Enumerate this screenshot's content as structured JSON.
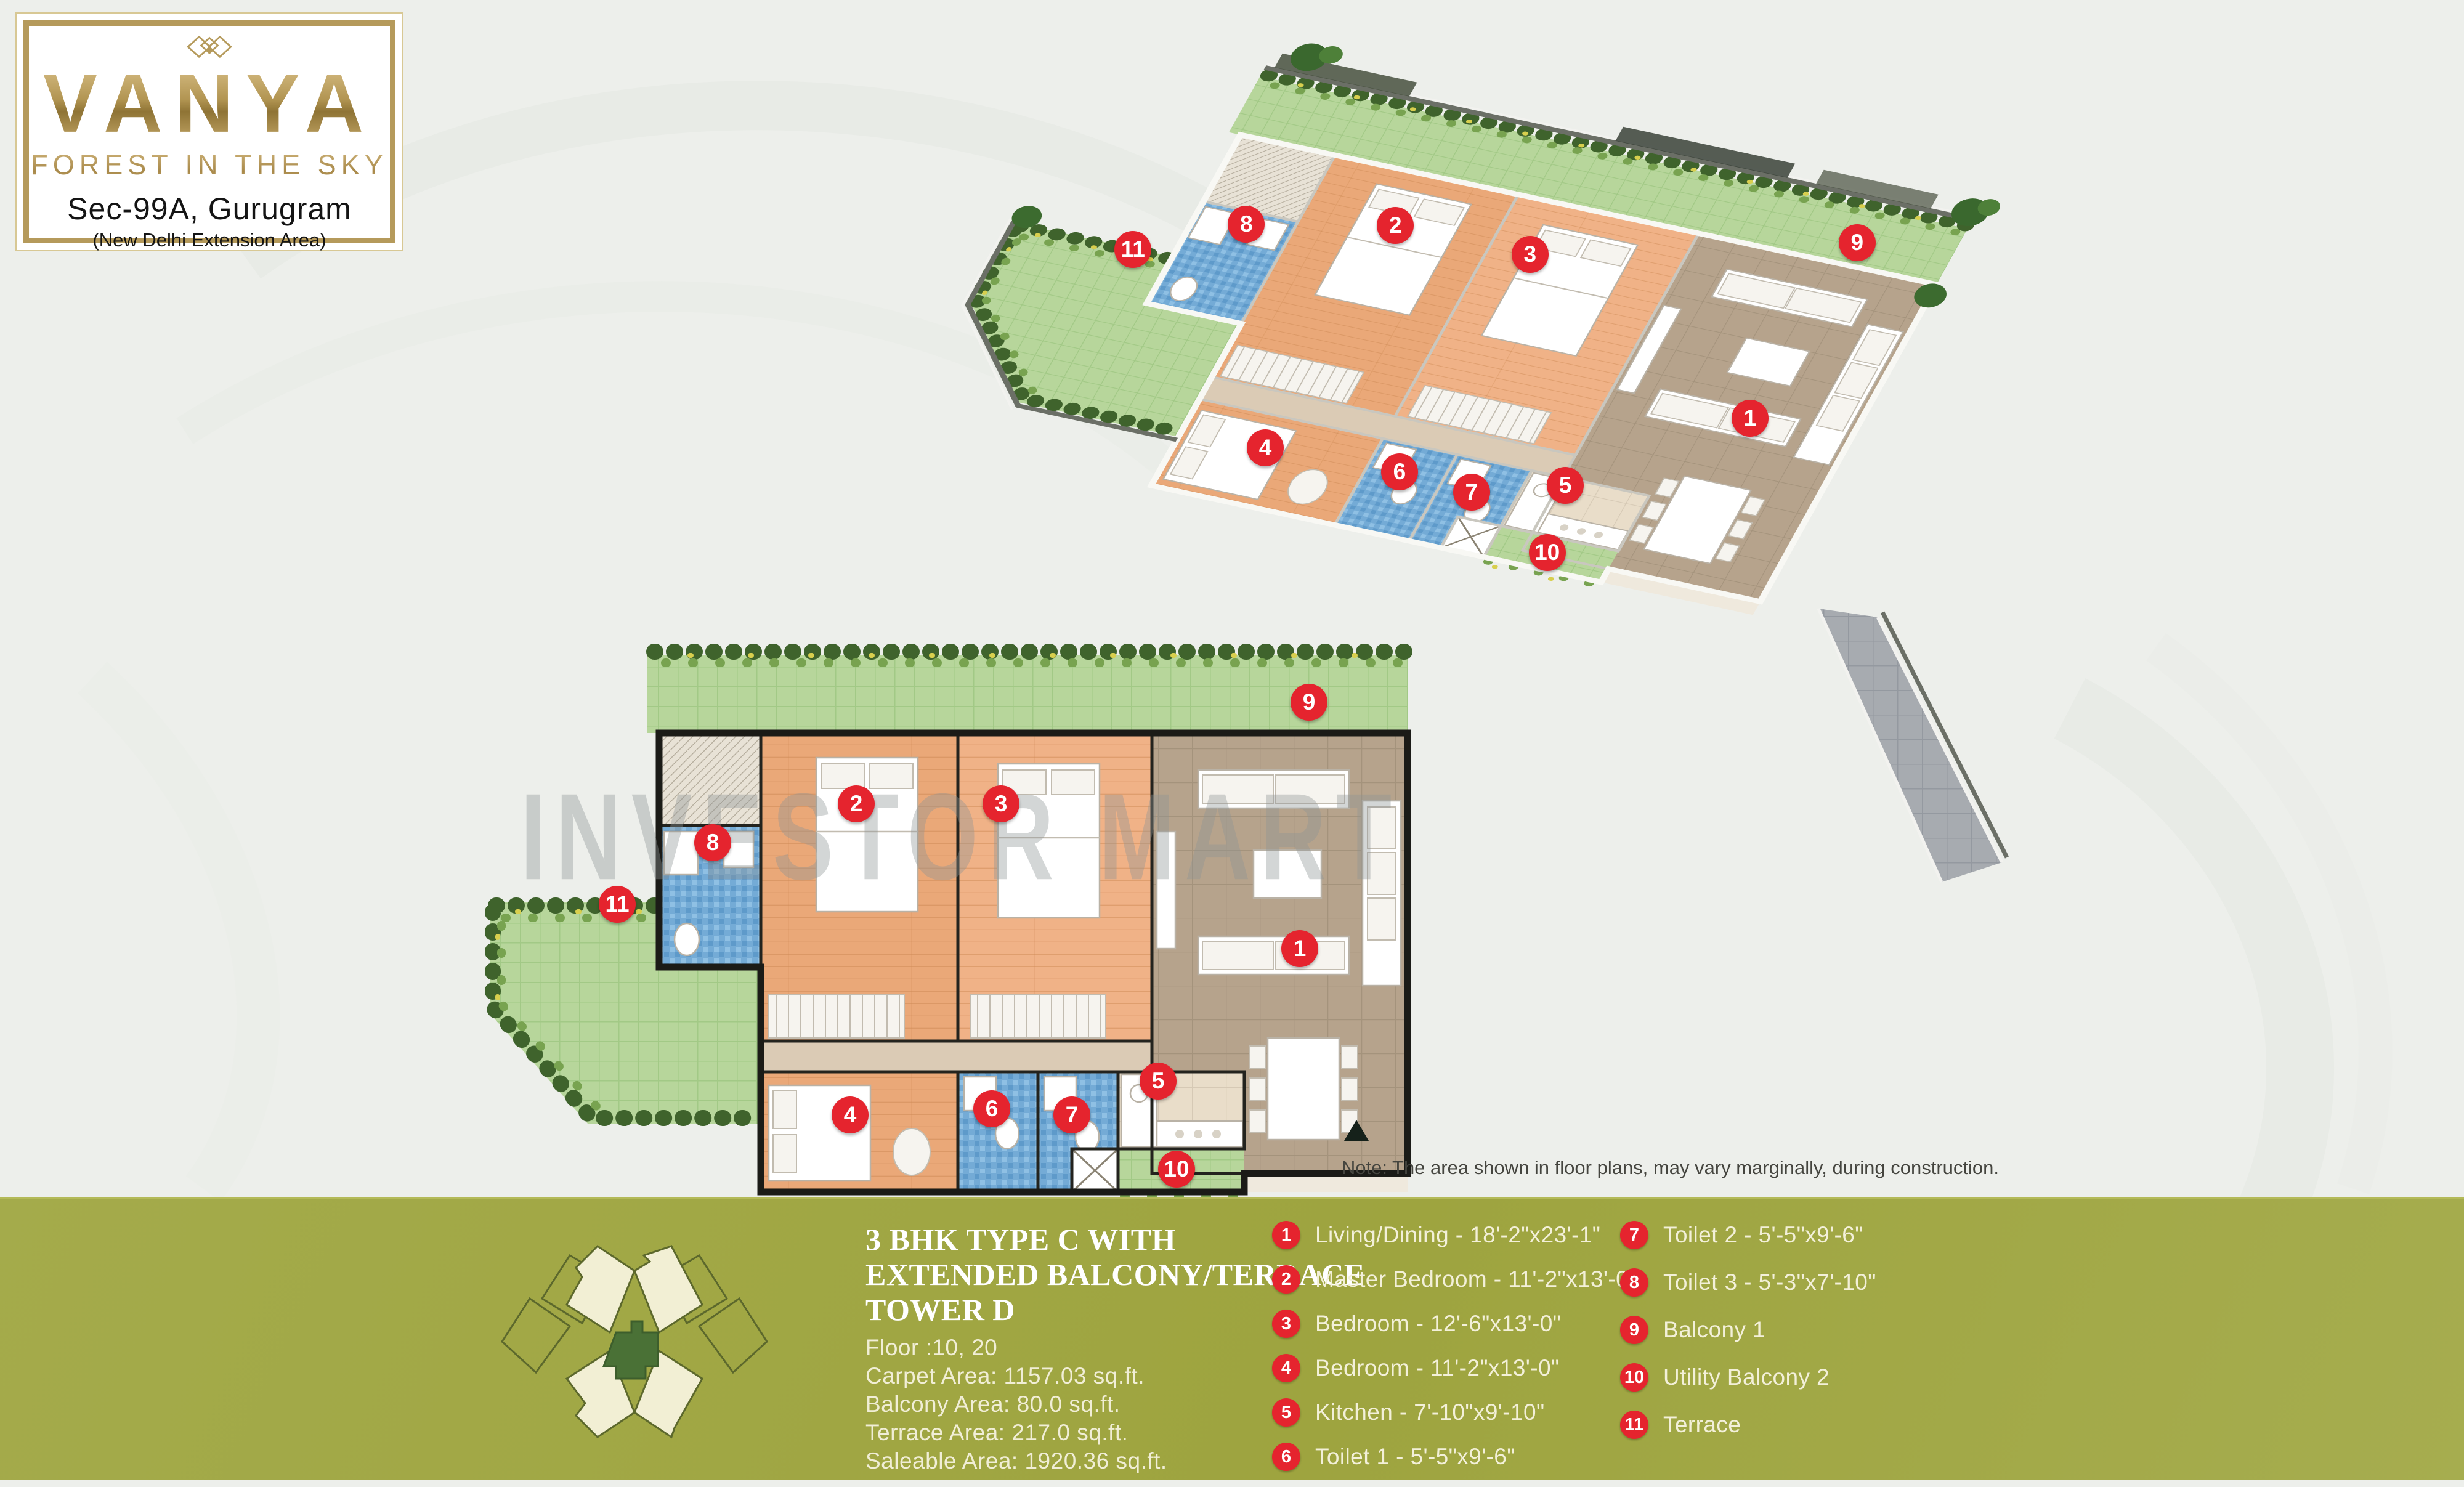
{
  "logo": {
    "brand": "VANYA",
    "tagline": "FOREST IN THE SKY",
    "location": "Sec-99A, Gurugram",
    "sublocation": "(New Delhi Extension Area)"
  },
  "watermark": "INVESTOR MART",
  "note": "Note: The area shown in floor plans, may vary marginally, during construction.",
  "unit": {
    "title_lines": [
      "3 BHK TYPE C WITH",
      "EXTENDED BALCONY/TERRACE",
      "TOWER D"
    ],
    "floor": "Floor :10, 20",
    "carpet_area": "Carpet Area: 1157.03 sq.ft.",
    "balcony_area": "Balcony Area: 80.0 sq.ft.",
    "terrace_area": "Terrace Area: 217.0 sq.ft.",
    "saleable_area": "Saleable Area: 1920.36 sq.ft."
  },
  "legend": {
    "col1": [
      {
        "num": "1",
        "label": "Living/Dining - 18'-2\"x23'-1\""
      },
      {
        "num": "2",
        "label": "Master Bedroom - 11'-2\"x13'-0\""
      },
      {
        "num": "3",
        "label": "Bedroom - 12'-6\"x13'-0\""
      },
      {
        "num": "4",
        "label": "Bedroom - 11'-2\"x13'-0\""
      },
      {
        "num": "5",
        "label": "Kitchen - 7'-10\"x9'-10\""
      },
      {
        "num": "6",
        "label": "Toilet 1 - 5'-5\"x9'-6\""
      }
    ],
    "col2": [
      {
        "num": "7",
        "label": "Toilet 2 - 5'-5\"x9'-6\""
      },
      {
        "num": "8",
        "label": "Toilet 3 - 5'-3\"x7'-10\""
      },
      {
        "num": "9",
        "label": "Balcony 1"
      },
      {
        "num": "10",
        "label": "Utility Balcony 2"
      },
      {
        "num": "11",
        "label": "Terrace"
      }
    ]
  },
  "markers": [
    {
      "num": "1",
      "u": 1330,
      "v": 490
    },
    {
      "num": "2",
      "u": 610,
      "v": 255
    },
    {
      "num": "3",
      "u": 845,
      "v": 255
    },
    {
      "num": "4",
      "u": 600,
      "v": 760
    },
    {
      "num": "5",
      "u": 1100,
      "v": 705
    },
    {
      "num": "6",
      "u": 830,
      "v": 750
    },
    {
      "num": "7",
      "u": 960,
      "v": 760
    },
    {
      "num": "8",
      "u": 377,
      "v": 318
    },
    {
      "num": "9",
      "u": 1345,
      "v": 90
    },
    {
      "num": "10",
      "u": 1130,
      "v": 848
    },
    {
      "num": "11",
      "u": 222,
      "v": 418
    }
  ],
  "colors": {
    "band_green": "#9ea43f",
    "marker_red": "#e5242e",
    "gold": "#b59a5b",
    "cream_text": "#f3f0d9",
    "background": "#edefeb",
    "grass": "#b7d69b",
    "wood_floor": "#eaa878",
    "living_tile": "#b6a38c",
    "toilet_blue": "#74abd6"
  }
}
